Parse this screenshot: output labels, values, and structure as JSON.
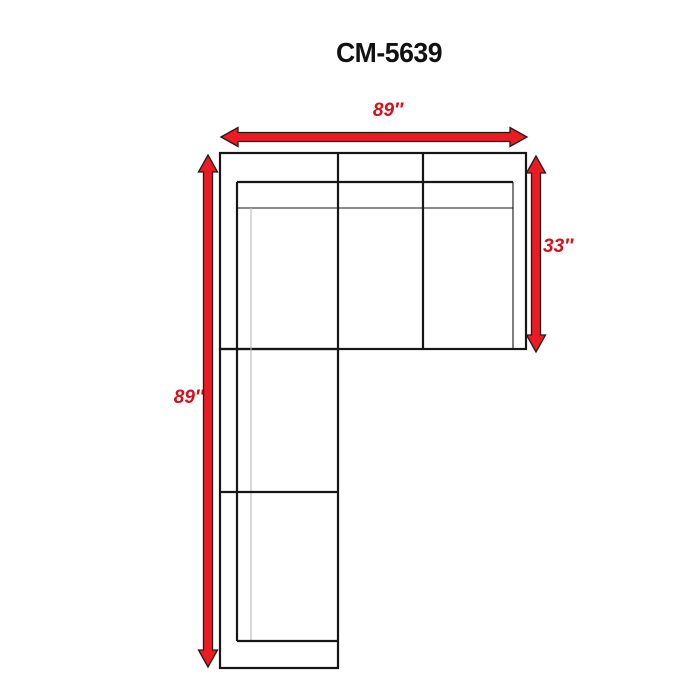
{
  "title": "CM-5639",
  "diagram": {
    "dimensions": {
      "top_width": "89″",
      "right_depth": "33″",
      "left_length": "89″"
    }
  },
  "colors": {
    "arrow_red": "#ec1b23",
    "arrow_outline": "#1f1a1a",
    "label_red": "#d2111b",
    "line_black": "#161616",
    "line_light": "#b8b8b8",
    "background": "#ffffff"
  }
}
